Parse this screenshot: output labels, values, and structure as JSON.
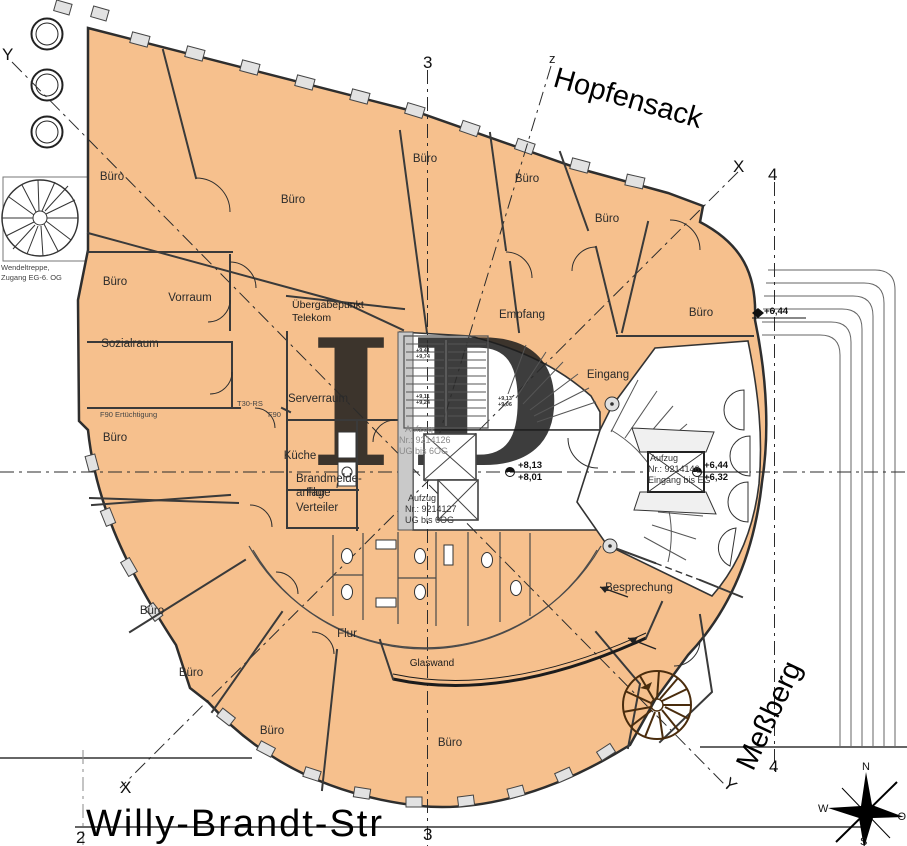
{
  "watermark": "ID",
  "streets": {
    "hopfensack": "Hopfensack",
    "messberg": "Meßberg",
    "willy_brandt": "Willy-Brandt-Str"
  },
  "axes": {
    "a2": "2",
    "a3": "3",
    "a4": "4",
    "x": "X",
    "y": "Y",
    "z": "z"
  },
  "compass": {
    "n": "N",
    "w": "W",
    "o": "O",
    "s": "S"
  },
  "rooms": {
    "buero": "Büro",
    "vorraum": "Vorraum",
    "sozialraum": "Sozialraum",
    "serverraum": "Serverraum",
    "kueche": "Küche",
    "empfang": "Empfang",
    "eingang": "Eingang",
    "besprechung": "Besprechung",
    "flur": "Flur",
    "glaswand": "Glaswand",
    "brandmelde_l1": "Brandmelde-",
    "brandmelde_l2": "anlage",
    "verteiler": "Verteiler",
    "uebergabe_l1": "Übergabepunkt",
    "uebergabe_l2": "Telekom",
    "wendeltreppe_l1": "Wendeltreppe,",
    "wendeltreppe_l2": "Zugang EG-6. OG",
    "f90_lang": "F90 Ertüchtigung",
    "t30": "T30-RS",
    "f90": "F90"
  },
  "lifts": {
    "lift1": {
      "l1": "Aufzug",
      "l2": "Nr.: 9214126",
      "l3": "UG bis 6OG"
    },
    "lift2": {
      "l1": "Aufzug",
      "l2": "Nr.: 9214127",
      "l3": "UG bis 6OG"
    },
    "lift3": {
      "l1": "Aufzug",
      "l2": "Nr.: 9214146",
      "l3": "Eingang bis EG"
    }
  },
  "levels": {
    "e644_top": "+6,44",
    "e813": "+8,13",
    "e801": "+8,01",
    "e644": "+6,44",
    "e632": "+6,32",
    "s1a": "+9,41",
    "s1b": "+9,74",
    "s2a": "+9,11",
    "s2b": "+9,24",
    "s3a": "+9,13",
    "s3b": "+9,06"
  },
  "colors": {
    "floor": "#f6c08d",
    "outline": "#2e2e2e",
    "stair_brown": "#4a2c0d",
    "watermark": "#e7e7e7"
  }
}
